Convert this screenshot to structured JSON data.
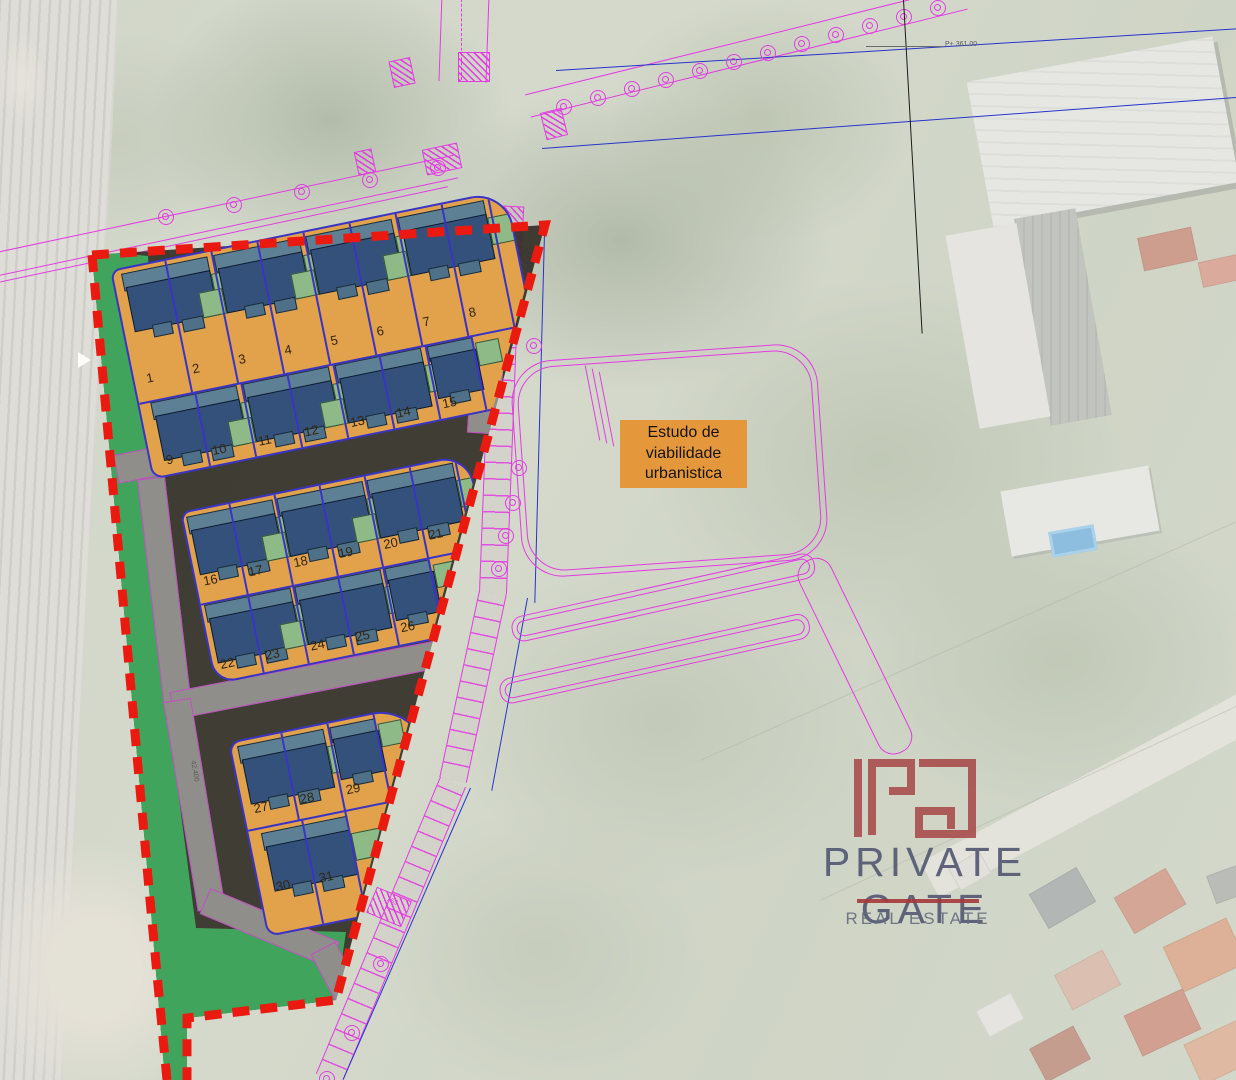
{
  "title": "Estudo de viabilidade urbanistica - site plan",
  "label_box": {
    "lines": [
      "Estudo de",
      "viabilidade",
      "urbanistica"
    ]
  },
  "site_plan": {
    "lot_count": 31,
    "blocks": [
      {
        "id": "block-a",
        "rows": [
          [
            "1",
            "2",
            "3",
            "4",
            "5",
            "6",
            "7",
            "8"
          ],
          [
            "9",
            "10",
            "11",
            "12",
            "13",
            "14",
            "15"
          ]
        ]
      },
      {
        "id": "block-b",
        "rows": [
          [
            "16",
            "17",
            "18",
            "19",
            "20",
            "21"
          ],
          [
            "22",
            "23",
            "24",
            "25",
            "26"
          ]
        ]
      },
      {
        "id": "block-c",
        "rows": [
          [
            "27",
            "28",
            "29"
          ],
          [
            "30",
            "31"
          ]
        ]
      }
    ]
  },
  "annotations": {
    "parcel_ref": "763",
    "level_mark": "P+ 361.00",
    "area_mark": "42.400"
  },
  "logo": {
    "monogram": "PG",
    "brand": "PRIVATE GATE",
    "tagline": "REAL ESTATE"
  },
  "colors": {
    "boundary_red": "#ea1a10",
    "plot_orange": "#e2a14b",
    "roof_navy": "#34517b",
    "roof_slate": "#5e8095",
    "garden_green": "#8eba88",
    "park_green": "#41a45d",
    "road_gray": "#8f8e8a",
    "ground_dark": "#343028",
    "cad_magenta": "#e23ce2",
    "cad_blue": "#2734cc",
    "lot_line_indigo": "#3a34c4",
    "logo_red": "#a43c3c",
    "logo_text": "#545973"
  }
}
